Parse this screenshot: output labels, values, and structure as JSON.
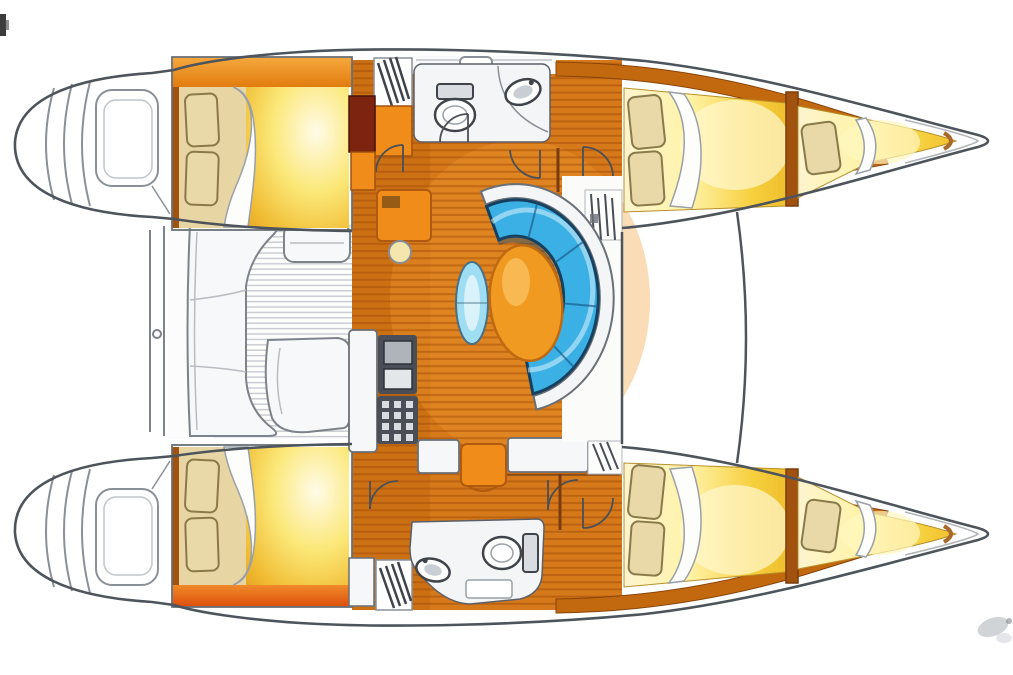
{
  "title": "Catamaran interior layout floor plan",
  "orientation": {
    "bow": "right",
    "stern": "left"
  },
  "rooms": {
    "port_hull": [
      {
        "id": "port-stern-platform",
        "label": "stern platform with transom steps"
      },
      {
        "id": "port-aft-cabin",
        "label": "aft double berth cabin with two pillows"
      },
      {
        "id": "port-companionway",
        "label": "companionway stairs down to hull"
      },
      {
        "id": "port-head",
        "label": "head with toilet and sink"
      },
      {
        "id": "port-forward-cabin",
        "label": "forward double berth with two pillows"
      },
      {
        "id": "port-forepeak",
        "label": "forepeak single berth"
      }
    ],
    "starboard_hull": [
      {
        "id": "stbd-stern-platform",
        "label": "stern platform with transom steps"
      },
      {
        "id": "stbd-aft-cabin",
        "label": "aft double berth cabin with two pillows"
      },
      {
        "id": "stbd-companionway",
        "label": "companionway stairs down to hull"
      },
      {
        "id": "stbd-head",
        "label": "head with toilet, sink and shower"
      },
      {
        "id": "stbd-forward-cabin",
        "label": "forward double berth with two pillows"
      },
      {
        "id": "stbd-forepeak",
        "label": "forepeak single berth"
      }
    ],
    "bridgedeck": [
      {
        "id": "cockpit",
        "label": "aft cockpit with bench seating and teak sole"
      },
      {
        "id": "salon",
        "label": "salon with curved settee and oval table"
      },
      {
        "id": "nav-station",
        "label": "nav station desk with stool"
      },
      {
        "id": "galley",
        "label": "galley with sink, stove and counters"
      },
      {
        "id": "mast-step",
        "label": "mast and rigging attachment"
      },
      {
        "id": "forward-beam",
        "label": "forward crossbeam / trampoline edge"
      }
    ]
  },
  "colors": {
    "hull_outline": "#4e545c",
    "hull_fill": "#ffffff",
    "inner_line": "#8a9098",
    "wood_base": "#d5791b",
    "wood_shade": "#c2660e",
    "wood_band": "#c2680f",
    "wood_bulkhead": "#a1520e",
    "furniture_orange": "#ef8c1a",
    "cabinet_red": "#7c2410",
    "footboard_red": "#e2590e",
    "bed_base_tan": "#e7d6a4",
    "pillow_tan": "#ead9a8",
    "pillow_outline": "#8a7a4a",
    "mattress_yellow": "#f6d44a",
    "mattress_pale": "#fdf4cf",
    "sheet_white": "#fdfdfb",
    "sofa_blue": "#3ab0e4",
    "sofa_shadow": "#1a4a70",
    "seatback_white": "#f4f5f6",
    "table_orange": "#f09a22",
    "table_rim": "#bf6a10",
    "stool_blue": "#9fdef2",
    "stool_cream": "#f5e6ae",
    "teak_line": "#c6cad0",
    "fixture_fill": "#f4f5f6",
    "fixture_outline": "#3f444b",
    "appliance_dark": "#4a4f57",
    "appliance_panel": "#d9dce0",
    "deck_white": "#fafafa"
  }
}
